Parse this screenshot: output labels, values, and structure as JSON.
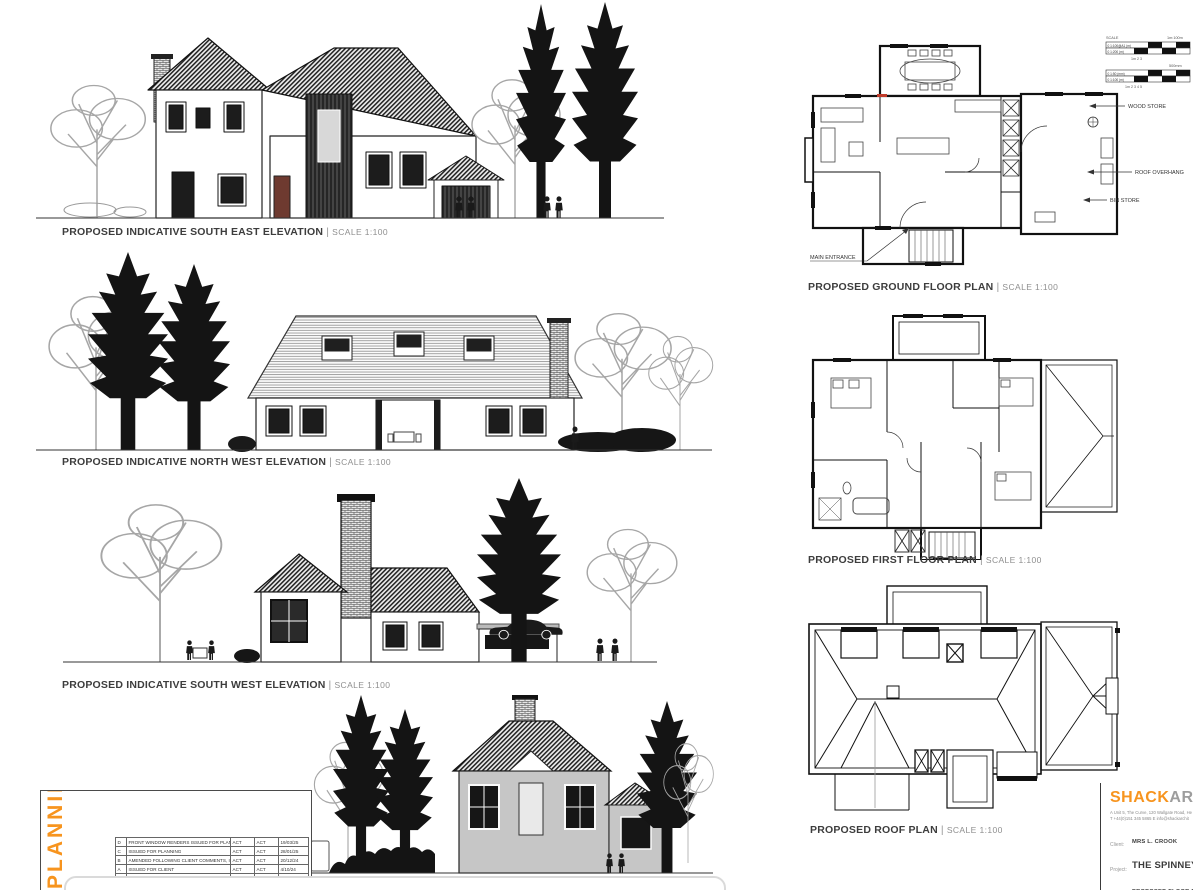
{
  "sheet": {
    "separator": "|",
    "accent_orange": "#F7941E",
    "ink": "#2b2b2b",
    "background": "#ffffff"
  },
  "elevations": [
    {
      "label": "PROPOSED INDICATIVE SOUTH EAST ELEVATION",
      "scale": "SCALE 1:100"
    },
    {
      "label": "PROPOSED INDICATIVE NORTH WEST ELEVATION",
      "scale": "SCALE 1:100"
    },
    {
      "label": "PROPOSED INDICATIVE SOUTH WEST ELEVATION",
      "scale": "SCALE 1:100"
    }
  ],
  "plans": [
    {
      "label": "PROPOSED GROUND FLOOR PLAN",
      "scale": "SCALE 1:100"
    },
    {
      "label": "PROPOSED FIRST FLOOR PLAN",
      "scale": "SCALE 1:100"
    },
    {
      "label": "PROPOSED ROOF PLAN",
      "scale": "SCALE 1:100"
    }
  ],
  "annotations": {
    "wood_store": "WOOD STORE",
    "roof_overhang": "ROOF OVERHANG",
    "bin_store": "BIN STORE",
    "main_entrance": "MAIN ENTRANCE"
  },
  "scale_bars": {
    "label": "SCALE",
    "g1_right": "1m:100m",
    "g1_row1": "0  1:100@A1 (m)",
    "g1_row2": "0  1:200 (m)",
    "g1_ticks": "1m        2         3",
    "g2_right": "500mm",
    "g2_row1": "0  1:50 (mm)",
    "g2_row2": "0  1:100 (m)",
    "g2_ticks": "1m    2     3     4     5"
  },
  "planning": {
    "stamp": "PLANNING",
    "header": {
      "revisions": "Revisions",
      "drawn": "Drawn",
      "checked": "Checked",
      "date": "Date"
    },
    "revisions": [
      {
        "rev": "D",
        "description": "FRONT WINDOW RENDERS ISSUED FOR PLANNING",
        "drawn": "ACT",
        "checked": "ACT",
        "date": "19/03/25"
      },
      {
        "rev": "C",
        "description": "ISSUED FOR PLANNING",
        "drawn": "ACT",
        "checked": "ACT",
        "date": "28/01/25"
      },
      {
        "rev": "B",
        "description": "AMENDED FOLLOWING CLIENT COMMENTS, ISSUED FOR PLANNING",
        "drawn": "ACT",
        "checked": "ACT",
        "date": "20/12/24"
      },
      {
        "rev": "A",
        "description": "ISSUED FOR CLIENT",
        "drawn": "ACT",
        "checked": "ACT",
        "date": "4/10/24"
      }
    ],
    "note_p1": "Copyright ",
    "note_hl": "SHACK",
    "note_p2": " Architecture Ltd. All dimensions to be checked on site. Do not scale from this drawing."
  },
  "title_block": {
    "brand_primary": "SHACK",
    "brand_secondary": "ARC",
    "address_line": "A   Unit 5, The Curve, 120 Wallgate Road, He",
    "contact_line": "T   +44(0)151 345 5865   E   info@shackarchit",
    "client_label": "Client:",
    "client_value": "MRS L. CROOK",
    "project_label": "Project:",
    "project_value": "THE SPINNEY -",
    "title_label": "Title:",
    "title_value": "PROPOSED FLOOR PLAN"
  }
}
